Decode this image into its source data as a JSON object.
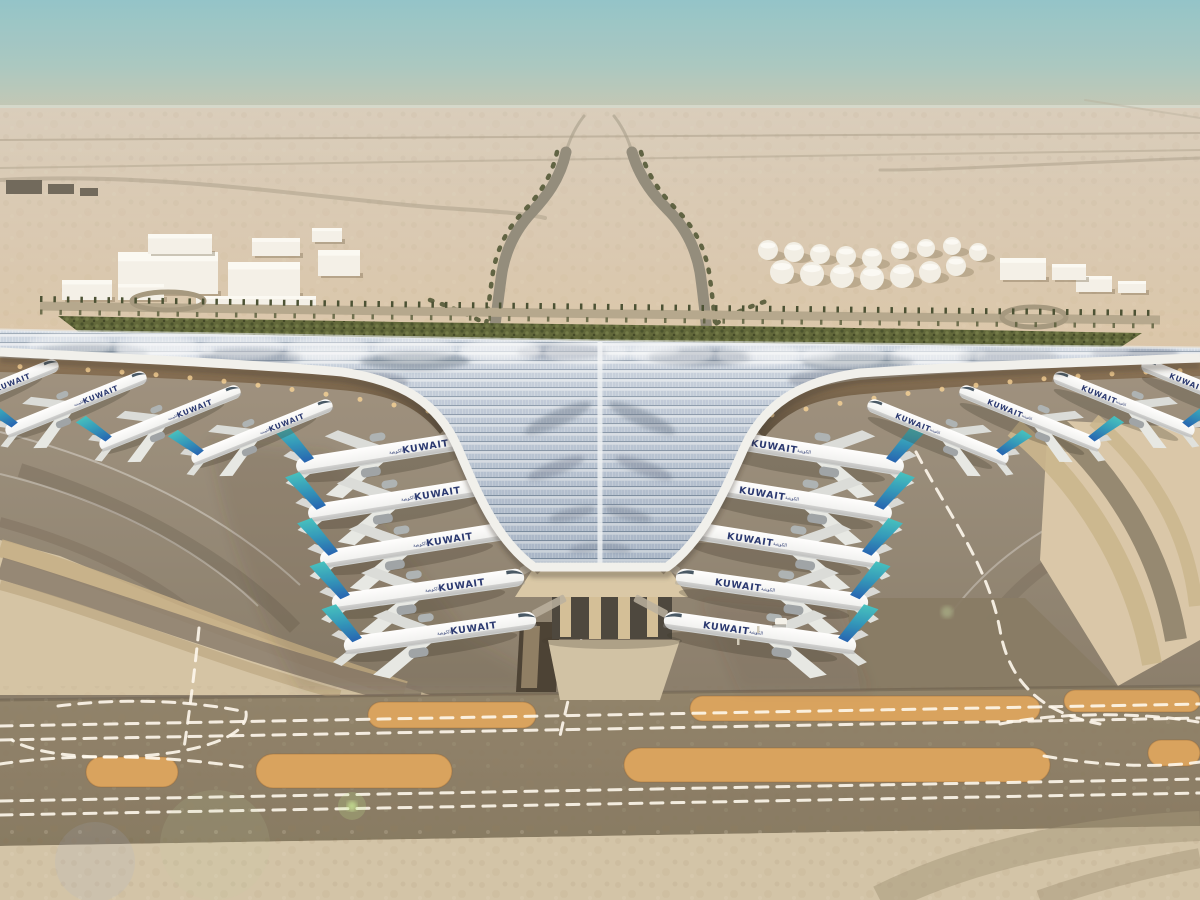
{
  "meta": {
    "description": "Aerial rendering of Kuwait International Airport new terminal: trefoil solar-panel roof, Kuwait Airways aircraft parked at gates, desert apron, taxiways and palm-lined approach roads"
  },
  "palette": {
    "sky_top": "#8fc2c8",
    "sky_horizon": "#c9c6b0",
    "sand_far": "#c7b79d",
    "sand_mid": "#dfcaaa",
    "sand_bottom": "#d1c2a5",
    "apron": "#9c8f7c",
    "taxiway": "#8a7c63",
    "sand_strip": "#d7a058",
    "marking_white": "#fffaee",
    "roof_blue": "#b6c4d6",
    "roof_dark": "#4e5e72",
    "eave_white": "#f1f1ec",
    "under_canopy": "#5c4b36",
    "glow_gold": "#ffd795",
    "green_band": "#5a6132",
    "tail_teal": "#36b3b6",
    "tail_blue": "#1e5fae",
    "livery_navy": "#20306b"
  },
  "aircraft": {
    "livery_text": "KUWAIT",
    "livery_text_arabic": "الكويتية",
    "groups": [
      {
        "name": "left-column",
        "mirror": false,
        "bridge": true,
        "planes": [
          {
            "x": 392,
            "y": 452,
            "a": -9,
            "s": 1
          },
          {
            "x": 404,
            "y": 499,
            "a": -9,
            "s": 1
          },
          {
            "x": 416,
            "y": 545,
            "a": -9,
            "s": 1
          },
          {
            "x": 428,
            "y": 590,
            "a": -8,
            "s": 1
          },
          {
            "x": 440,
            "y": 633,
            "a": -8,
            "s": 1
          }
        ]
      },
      {
        "name": "right-column",
        "mirror": true,
        "bridge": true,
        "planes": [
          {
            "x": 808,
            "y": 452,
            "a": -9,
            "s": 1
          },
          {
            "x": 796,
            "y": 499,
            "a": -9,
            "s": 1
          },
          {
            "x": 784,
            "y": 545,
            "a": -9,
            "s": 1
          },
          {
            "x": 772,
            "y": 590,
            "a": -8,
            "s": 1
          },
          {
            "x": 760,
            "y": 633,
            "a": -8,
            "s": 1
          }
        ]
      },
      {
        "name": "left-wing",
        "mirror": false,
        "bridge": false,
        "planes": [
          {
            "x": -12,
            "y": 392,
            "a": -22,
            "s": 0.78
          },
          {
            "x": 76,
            "y": 404,
            "a": -22,
            "s": 0.78
          },
          {
            "x": 170,
            "y": 418,
            "a": -22,
            "s": 0.78
          },
          {
            "x": 262,
            "y": 432,
            "a": -22,
            "s": 0.78
          }
        ]
      },
      {
        "name": "right-wing",
        "mirror": true,
        "bridge": false,
        "planes": [
          {
            "x": 1212,
            "y": 392,
            "a": -22,
            "s": 0.78
          },
          {
            "x": 1124,
            "y": 404,
            "a": -22,
            "s": 0.78
          },
          {
            "x": 1030,
            "y": 418,
            "a": -22,
            "s": 0.78
          },
          {
            "x": 938,
            "y": 432,
            "a": -22,
            "s": 0.78
          }
        ]
      }
    ]
  },
  "ground": {
    "strips_row1": [
      {
        "x": 368,
        "y": 702,
        "w": 168,
        "h": 26
      },
      {
        "x": 690,
        "y": 696,
        "w": 350,
        "h": 25
      },
      {
        "x": 1064,
        "y": 690,
        "w": 136,
        "h": 22
      }
    ],
    "strips_row2": [
      {
        "x": 86,
        "y": 757,
        "w": 92,
        "h": 30
      },
      {
        "x": 256,
        "y": 754,
        "w": 196,
        "h": 34
      },
      {
        "x": 624,
        "y": 748,
        "w": 426,
        "h": 34
      },
      {
        "x": 1148,
        "y": 740,
        "w": 52,
        "h": 26
      }
    ],
    "dash_paths": [
      "M0,726 L1200,704",
      "M0,740 L1200,718",
      "M0,801 L1200,779",
      "M0,815 L1200,793",
      "M199,628 C195,668 190,708 184,748",
      "M585,620 C578,660 568,700 560,736",
      "M58,706 C120,698 190,700 246,712",
      "M246,712 C250,736 200,752 140,756 C80,760 30,752 12,740",
      "M0,764 C80,752 170,756 250,768",
      "M916,452 C952,520 988,566 1000,630 C1010,688 1048,714 1100,724",
      "M1000,724 C1060,712 1140,712 1198,722",
      "M1044,756 C1100,766 1160,768 1200,762"
    ]
  },
  "structures": {
    "left_cluster": [
      {
        "x": 118,
        "y": 252,
        "w": 100,
        "h": 42
      },
      {
        "x": 228,
        "y": 262,
        "w": 72,
        "h": 34
      },
      {
        "x": 148,
        "y": 234,
        "w": 64,
        "h": 20
      },
      {
        "x": 252,
        "y": 238,
        "w": 48,
        "h": 18
      },
      {
        "x": 318,
        "y": 250,
        "w": 42,
        "h": 26
      },
      {
        "x": 312,
        "y": 228,
        "w": 30,
        "h": 14
      },
      {
        "x": 196,
        "y": 296,
        "w": 120,
        "h": 12
      },
      {
        "x": 62,
        "y": 280,
        "w": 50,
        "h": 20
      },
      {
        "x": 118,
        "y": 284,
        "w": 46,
        "h": 16
      }
    ],
    "far_left": [
      {
        "x": 6,
        "y": 180,
        "w": 36,
        "h": 14
      },
      {
        "x": 48,
        "y": 184,
        "w": 26,
        "h": 10
      },
      {
        "x": 80,
        "y": 188,
        "w": 18,
        "h": 8
      }
    ],
    "right_sheds": [
      {
        "x": 1076,
        "y": 276,
        "w": 36,
        "h": 16
      },
      {
        "x": 1118,
        "y": 281,
        "w": 28,
        "h": 12
      },
      {
        "x": 1000,
        "y": 258,
        "w": 46,
        "h": 22
      },
      {
        "x": 1052,
        "y": 264,
        "w": 34,
        "h": 16
      }
    ],
    "tanks": [
      {
        "x": 768,
        "y": 250,
        "r": 10
      },
      {
        "x": 794,
        "y": 252,
        "r": 10
      },
      {
        "x": 820,
        "y": 254,
        "r": 10
      },
      {
        "x": 846,
        "y": 256,
        "r": 10
      },
      {
        "x": 872,
        "y": 258,
        "r": 10
      },
      {
        "x": 782,
        "y": 272,
        "r": 12
      },
      {
        "x": 812,
        "y": 274,
        "r": 12
      },
      {
        "x": 842,
        "y": 276,
        "r": 12
      },
      {
        "x": 872,
        "y": 278,
        "r": 12
      },
      {
        "x": 902,
        "y": 276,
        "r": 12
      },
      {
        "x": 930,
        "y": 272,
        "r": 11
      },
      {
        "x": 956,
        "y": 266,
        "r": 10
      },
      {
        "x": 900,
        "y": 250,
        "r": 9
      },
      {
        "x": 926,
        "y": 248,
        "r": 9
      },
      {
        "x": 952,
        "y": 246,
        "r": 9
      },
      {
        "x": 978,
        "y": 252,
        "r": 9
      }
    ]
  }
}
